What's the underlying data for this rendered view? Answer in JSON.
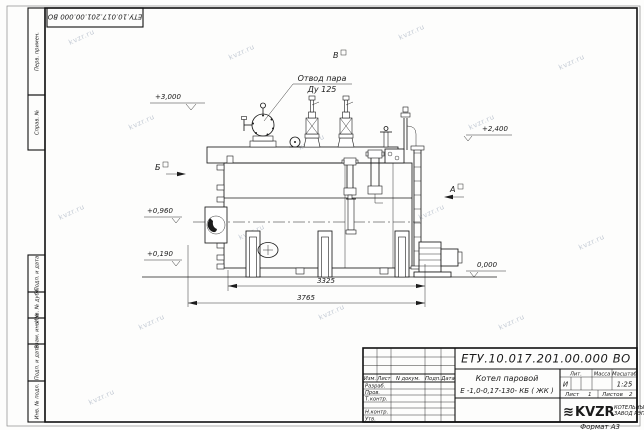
{
  "doc": {
    "number": "ЕТУ.10.017.201.00.000  ВО"
  },
  "watermark": {
    "text": "kvzr.ru"
  },
  "frame": {
    "format_label": "Формат А3",
    "margin_boxes": [
      {
        "label": "Перв. примен."
      },
      {
        "label": "Справ. №"
      },
      {
        "label": "Подп. и дата"
      },
      {
        "label": "Инв. № дубл."
      },
      {
        "label": "Взам. инв. №"
      },
      {
        "label": "Подп. и дата"
      },
      {
        "label": "Инв. № подл."
      }
    ]
  },
  "drawing": {
    "steam_label_line1": "Отвод пара",
    "steam_label_line2": "Ду 125",
    "view_marks": {
      "top": "В",
      "left": "Б",
      "right": "А"
    },
    "elevations": {
      "e3000": "+3,000",
      "e2400": "+2,400",
      "e0960": "+0,960",
      "e0190": "+0,190",
      "zero": "0,000"
    },
    "dims": {
      "d1": "3325",
      "d2": "3765"
    }
  },
  "title_block": {
    "name_line1": "Котел паровой",
    "name_line2": "Е -1,0-0,17-130- КБ ( ЖК )",
    "cols": {
      "izm": "Изм.",
      "list": "Лист",
      "ndoc": "N докум.",
      "podp": "Подп.",
      "data": "Дата"
    },
    "rows": {
      "r1": "Разраб.",
      "r2": "Пров.",
      "r3": "Т.контр.",
      "r4": "",
      "r5": "Н.контр.",
      "r6": "Утв."
    },
    "lit": {
      "header": "Лит.",
      "value": "И"
    },
    "mass": {
      "header": "Масса",
      "value": ""
    },
    "scale": {
      "header": "Масштаб",
      "value": "1:25"
    },
    "sheet": {
      "label": "Лист",
      "value": "1"
    },
    "sheets": {
      "label": "Листов",
      "value": "2"
    },
    "logo": {
      "mark": "≋",
      "text": "KVZR",
      "sub1": "КОТЕЛЬНЫЙ",
      "sub2": "ЗАВОД РЭП"
    }
  }
}
